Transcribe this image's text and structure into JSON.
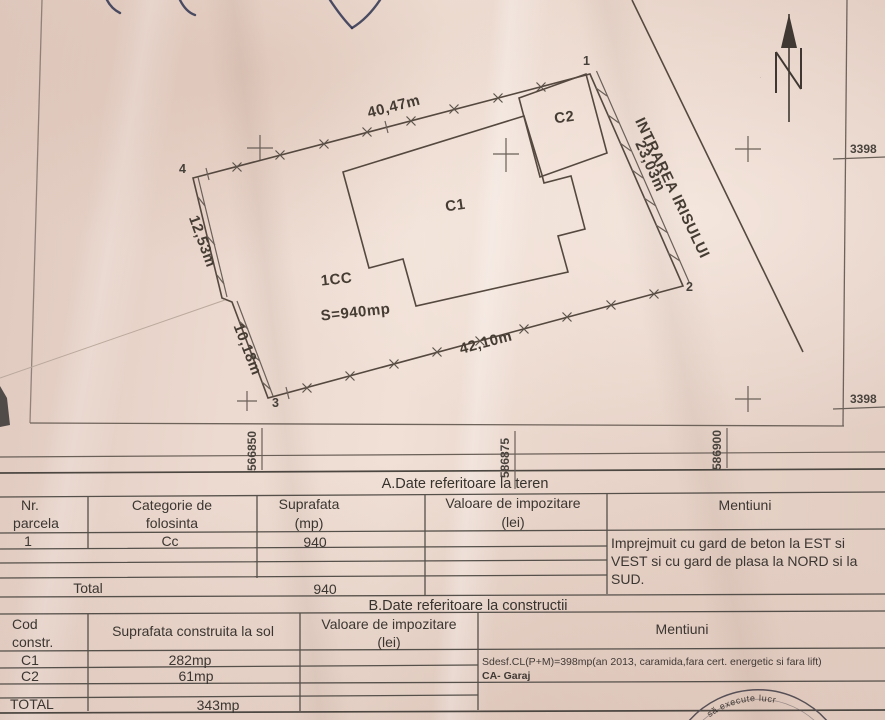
{
  "plan": {
    "north_label": "N",
    "street_label": "INTRAREA IRISULUI",
    "zone_label": "1CC",
    "area_label": "S=940mp",
    "building_c1": "C1",
    "building_c2": "C2",
    "dim_top": "40,47m",
    "dim_east": "23,03m",
    "dim_bottom": "42,10m",
    "dim_west_upper": "12,53m",
    "dim_west_lower": "10,18m",
    "pt1": "1",
    "pt2": "2",
    "pt3": "3",
    "pt4": "4",
    "grid_x": {
      "g1": "566850",
      "g2": "586875",
      "g3": "586900"
    },
    "grid_y": {
      "g1": "3398",
      "g2": "3398"
    }
  },
  "section_a": {
    "title": "A.Date referitoare la teren",
    "col_nr_1": "Nr.",
    "col_nr_2": "parcela",
    "col_cat_1": "Categorie de",
    "col_cat_2": "folosinta",
    "col_sup_1": "Suprafata",
    "col_sup_2": "(mp)",
    "col_val_1": "Valoare de impozitare",
    "col_val_2": "(lei)",
    "col_men": "Mentiuni",
    "row1": {
      "nr": "1",
      "categorie": "Cc",
      "suprafata": "940"
    },
    "total_label": "Total",
    "total_value": "940",
    "mentiuni_1": "Imprejmuit cu gard de beton la EST si",
    "mentiuni_2": "VEST si cu gard de plasa la NORD si la",
    "mentiuni_3": "SUD."
  },
  "section_b": {
    "title": "B.Date referitoare la constructii",
    "col_cod_1": "Cod",
    "col_cod_2": "constr.",
    "col_sup": "Suprafata construita la sol",
    "col_val_1": "Valoare de impozitare",
    "col_val_2": "(lei)",
    "col_men": "Mentiuni",
    "rows": [
      {
        "cod": "C1",
        "suprafata": "282mp"
      },
      {
        "cod": "C2",
        "suprafata": "61mp"
      }
    ],
    "total_label": "TOTAL",
    "total_value": "343mp",
    "mentiuni_1": "Sdesf.CL(P+M)=398mp(an 2013, caramida,fara cert. energetic si fara lift)",
    "mentiuni_2": "CA- Garaj"
  },
  "stamp": {
    "text": "să execute lucr"
  }
}
